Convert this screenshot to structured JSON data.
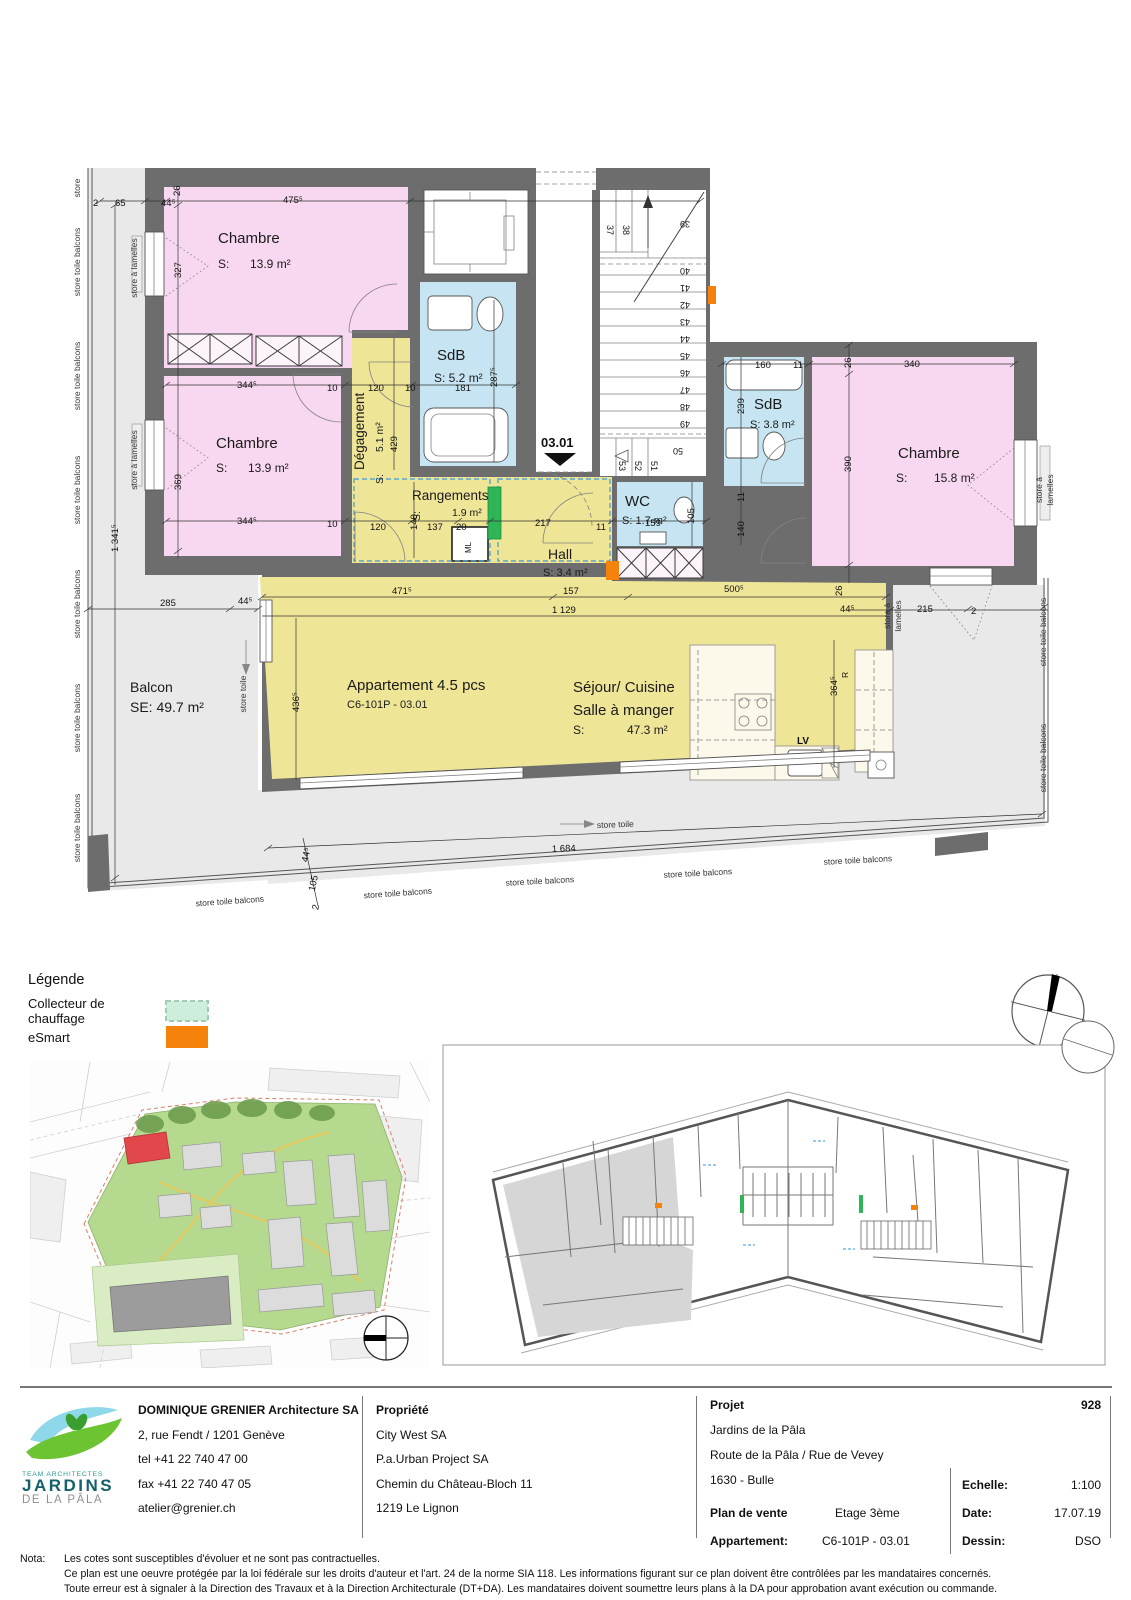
{
  "plan": {
    "entry": {
      "label": "03.01"
    },
    "apartment": {
      "line1": "Appartement 4.5 pcs",
      "line2": "C6-101P - 03.01"
    },
    "rooms": {
      "chambre1": {
        "name": "Chambre",
        "s": "S:",
        "area": "13.9 m²"
      },
      "chambre2": {
        "name": "Chambre",
        "s": "S:",
        "area": "13.9 m²"
      },
      "chambre3": {
        "name": "Chambre",
        "s": "S:",
        "area": "15.8 m²"
      },
      "sdb1": {
        "name": "SdB",
        "area": "S: 5.2 m²"
      },
      "sdb2": {
        "name": "SdB",
        "area": "S: 3.8 m²"
      },
      "wc": {
        "name": "WC",
        "area": "S: 1.7 m²"
      },
      "hall": {
        "name": "Hall",
        "area": "S: 3.4 m²"
      },
      "degagement": {
        "name": "Dégagement",
        "s": "S:",
        "area": "5.1 m²"
      },
      "rangements": {
        "name": "Rangements",
        "s": "S:",
        "area": "1.9 m²"
      },
      "sejour": {
        "line1": "Séjour/ Cuisine",
        "line2": "Salle à manger",
        "s": "S:",
        "area": "47.3 m²"
      },
      "balcon": {
        "name": "Balcon",
        "area": "SE: 49.7 m²"
      }
    },
    "appliances": {
      "lv": "LV",
      "ml": "ML",
      "r": "R"
    },
    "stairs": [
      "37",
      "38",
      "39",
      "40",
      "41",
      "42",
      "43",
      "44",
      "45",
      "46",
      "47",
      "48",
      "49",
      "50",
      "51",
      "52",
      "53"
    ],
    "dims": {
      "v2a": "2",
      "v65": "65",
      "v44a": "44⁵",
      "v26a": "26",
      "v475": "475⁵",
      "v327": "327",
      "v344a": "344⁵",
      "v10a": "10",
      "v120a": "120",
      "v10b": "10",
      "v181": "181",
      "v287": "287⁵",
      "v369": "369",
      "v344b": "344⁵",
      "v10c": "10",
      "v120b": "120",
      "v140a": "140",
      "v137": "137",
      "v20": "20",
      "v217": "217",
      "v11a": "11",
      "v159": "159",
      "v105a": "105",
      "v429": "429",
      "v160": "160",
      "v11b": "11",
      "v26b": "26",
      "v340": "340",
      "v239": "239",
      "v390": "390",
      "v11c": "11",
      "v140b": "140",
      "v471": "471⁵",
      "v157": "157",
      "v500": "500⁵",
      "v1129": "1 129",
      "v26c": "26",
      "v44b": "44⁵",
      "v215": "215",
      "v2b": "2",
      "v285": "285",
      "v44c": "44⁵",
      "v436": "436⁵",
      "v364": "364⁵",
      "v1684": "1 684",
      "v1341": "1 341⁵",
      "v44d": "44⁵",
      "v105b": "105",
      "v2c": "2"
    },
    "stores": {
      "store": "store",
      "balcons": "store toile balcons",
      "lamelles": "store à lamelles",
      "lamelles1": "store à",
      "lamelles2": "lamelles",
      "toile": "store toile"
    }
  },
  "legend": {
    "title": "Légende",
    "items": [
      {
        "label": "Collecteur de chauffage",
        "color": "#cdeedd"
      },
      {
        "label": "eSmart",
        "color": "#f5820a"
      }
    ]
  },
  "colors": {
    "wall": "#6d6d6d",
    "room_pink": "#f8d8f0",
    "room_yellow": "#efe597",
    "room_blue": "#c6e4f2",
    "balcony": "#e9e9e9",
    "collecteur_plan": "#2fb457",
    "esmart": "#f5820a",
    "site_green": "#b5d98e",
    "site_red": "#e2474b"
  },
  "titleblock": {
    "logo": {
      "team": "TEAM ARCHITECTES",
      "line1": "JARDINS",
      "line2": "DE LA PÂLA"
    },
    "architect": {
      "name": "DOMINIQUE GRENIER Architecture SA",
      "address": "2, rue Fendt / 1201 Genève",
      "tel": "tel +41 22 740 47 00",
      "fax": "fax +41 22 740 47 05",
      "email": "atelier@grenier.ch"
    },
    "owner": {
      "heading": "Propriété",
      "line1": "City West SA",
      "line2": "P.a.Urban Project SA",
      "line3": "Chemin du Château-Bloch 11",
      "line4": "1219 Le Lignon"
    },
    "project": {
      "heading": "Projet",
      "number": "928",
      "line1": "Jardins de la Pâla",
      "line2": "Route de la Pâla / Rue de Vevey",
      "line3": "1630 - Bulle",
      "plan_label": "Plan de vente",
      "plan_value": "Etage 3ème",
      "apt_label": "Appartement:",
      "apt_value": "C6-101P - 03.01",
      "scale_label": "Echelle:",
      "scale_value": "1:100",
      "date_label": "Date:",
      "date_value": "17.07.19",
      "dessin_label": "Dessin:",
      "dessin_value": "DSO"
    }
  },
  "notes": {
    "nota": "Nota:",
    "line1": "Les cotes sont susceptibles d'évoluer et ne sont pas contractuelles.",
    "line2": "Ce plan est une oeuvre protégée par la loi fédérale sur les droits d'auteur et l'art. 24 de la norme SIA 118. Les informations figurant sur ce plan doivent être contrôlées par les mandataires concernés.",
    "line3": "Toute erreur est à signaler à la Direction des Travaux et à la Direction Architecturale (DT+DA). Les mandataires doivent soumettre leurs plans à la DA pour approbation avant exécution ou commande."
  }
}
